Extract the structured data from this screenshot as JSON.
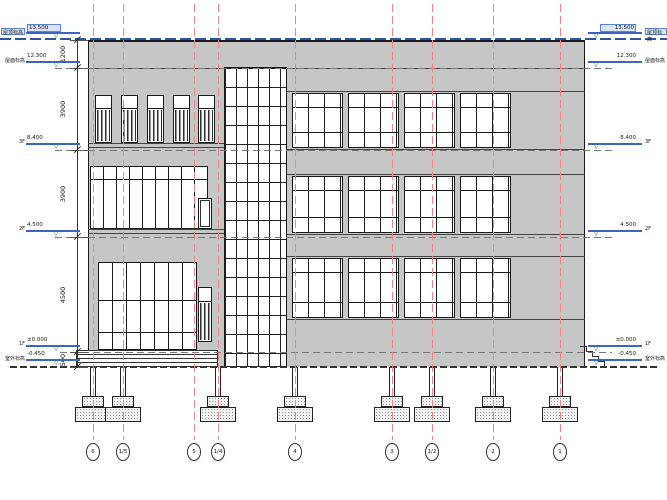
{
  "colors": {
    "wall": "#c6c6c6",
    "grid_line": "#ec8585",
    "level_marker": "#3a67be",
    "highlight_fill": "#d9e4f6",
    "highlight_border": "#5b85cf",
    "ink": "#1a1a1a",
    "dash_line": "#777777",
    "blue_dash": "#2b55a8"
  },
  "levels": [
    {
      "label": "屋顶标高",
      "value": "13.500",
      "y": 39,
      "highlight": true
    },
    {
      "label": "屋面标高",
      "value": "12.300",
      "y": 68,
      "highlight": false
    },
    {
      "label": "3F",
      "value": "8.400",
      "y": 150,
      "highlight": false
    },
    {
      "label": "2F",
      "value": "4.500",
      "y": 237,
      "highlight": false
    },
    {
      "label": "1F",
      "value": "±0.000",
      "y": 352,
      "highlight": false
    },
    {
      "label": "室外标高",
      "value": "-0.450",
      "y": 366,
      "highlight": false
    }
  ],
  "dimensions": [
    {
      "label": "1200",
      "from": 40,
      "to": 68
    },
    {
      "label": "3900",
      "from": 68,
      "to": 150
    },
    {
      "label": "3900",
      "from": 150,
      "to": 237
    },
    {
      "label": "4500",
      "from": 237,
      "to": 352
    },
    {
      "label": "500",
      "from": 352,
      "to": 367
    }
  ],
  "grids": [
    {
      "id": "6",
      "x": 93
    },
    {
      "id": "1/5",
      "x": 123
    },
    {
      "id": "5",
      "x": 194
    },
    {
      "id": "1/4",
      "x": 218
    },
    {
      "id": "4",
      "x": 295
    },
    {
      "id": "3",
      "x": 392
    },
    {
      "id": "1/2",
      "x": 432
    },
    {
      "id": "2",
      "x": 493
    },
    {
      "id": "1",
      "x": 560
    }
  ],
  "building": {
    "x": 88,
    "y": 40,
    "w": 497,
    "h": 327,
    "solid_lines": [
      {
        "x": 88,
        "y": 68,
        "w": 497
      },
      {
        "x": 88,
        "y": 143,
        "w": 136
      },
      {
        "x": 88,
        "y": 147,
        "w": 136
      },
      {
        "x": 88,
        "y": 229,
        "w": 136
      },
      {
        "x": 88,
        "y": 233,
        "w": 136
      },
      {
        "x": 287,
        "y": 91,
        "w": 298
      },
      {
        "x": 287,
        "y": 149,
        "w": 298
      },
      {
        "x": 287,
        "y": 174,
        "w": 298
      },
      {
        "x": 287,
        "y": 234,
        "w": 298
      },
      {
        "x": 287,
        "y": 256,
        "w": 298
      },
      {
        "x": 287,
        "y": 319,
        "w": 298
      }
    ],
    "windows": [
      {
        "kind": "narrow",
        "x": 95,
        "y": 95,
        "w": 17,
        "h": 48,
        "top": 13
      },
      {
        "kind": "narrow",
        "x": 121,
        "y": 95,
        "w": 17,
        "h": 48,
        "top": 13
      },
      {
        "kind": "narrow",
        "x": 147,
        "y": 95,
        "w": 17,
        "h": 48,
        "top": 13
      },
      {
        "kind": "narrow",
        "x": 173,
        "y": 95,
        "w": 17,
        "h": 48,
        "top": 13
      },
      {
        "kind": "narrow",
        "x": 198,
        "y": 95,
        "w": 17,
        "h": 48,
        "top": 13
      },
      {
        "kind": "storefront",
        "x": 90,
        "y": 166,
        "w": 118,
        "h": 63,
        "mullion": 13,
        "transoms": [
          13
        ]
      },
      {
        "kind": "door",
        "x": 198,
        "y": 198,
        "w": 14,
        "h": 31
      },
      {
        "kind": "storefront",
        "x": 98,
        "y": 262,
        "w": 99,
        "h": 88,
        "mullion": 14,
        "transoms": [
          38,
          70
        ]
      },
      {
        "kind": "narrow",
        "x": 198,
        "y": 287,
        "w": 14,
        "h": 55,
        "top": 14
      },
      {
        "kind": "curtain",
        "x": 224,
        "y": 67,
        "w": 63,
        "h": 300,
        "mullion": 11,
        "transom": 19
      },
      {
        "kind": "paned",
        "x": 292,
        "y": 93,
        "w": 51,
        "h": 55,
        "transoms": [
          14,
          39
        ]
      },
      {
        "kind": "paned",
        "x": 348,
        "y": 93,
        "w": 51,
        "h": 55,
        "transoms": [
          14,
          39
        ]
      },
      {
        "kind": "paned",
        "x": 404,
        "y": 93,
        "w": 51,
        "h": 55,
        "transoms": [
          14,
          39
        ]
      },
      {
        "kind": "paned",
        "x": 460,
        "y": 93,
        "w": 51,
        "h": 55,
        "transoms": [
          14,
          39
        ]
      },
      {
        "kind": "paned",
        "x": 292,
        "y": 176,
        "w": 51,
        "h": 57,
        "transoms": [
          14,
          41
        ]
      },
      {
        "kind": "paned",
        "x": 348,
        "y": 176,
        "w": 51,
        "h": 57,
        "transoms": [
          14,
          41
        ]
      },
      {
        "kind": "paned",
        "x": 404,
        "y": 176,
        "w": 51,
        "h": 57,
        "transoms": [
          14,
          41
        ]
      },
      {
        "kind": "paned",
        "x": 460,
        "y": 176,
        "w": 51,
        "h": 57,
        "transoms": [
          14,
          41
        ]
      },
      {
        "kind": "paned",
        "x": 292,
        "y": 258,
        "w": 51,
        "h": 60,
        "transoms": [
          14,
          44
        ]
      },
      {
        "kind": "paned",
        "x": 348,
        "y": 258,
        "w": 51,
        "h": 60,
        "transoms": [
          14,
          44
        ]
      },
      {
        "kind": "paned",
        "x": 404,
        "y": 258,
        "w": 51,
        "h": 60,
        "transoms": [
          14,
          44
        ]
      },
      {
        "kind": "paned",
        "x": 460,
        "y": 258,
        "w": 51,
        "h": 60,
        "transoms": [
          14,
          44
        ]
      }
    ],
    "footings": {
      "xs": [
        93,
        123,
        218,
        295,
        392,
        432,
        493,
        560
      ],
      "shaft_top": 367,
      "shaft_h": 29,
      "cap": {
        "w": 22,
        "h": 11
      },
      "base": {
        "w": 36,
        "h": 15
      }
    },
    "steps_left": {
      "x": 76,
      "y": 350,
      "w": 142,
      "h": 17
    },
    "stair_right": {
      "x": 580,
      "y": 346,
      "step_w": 6,
      "step_h": 5,
      "count": 4
    }
  }
}
